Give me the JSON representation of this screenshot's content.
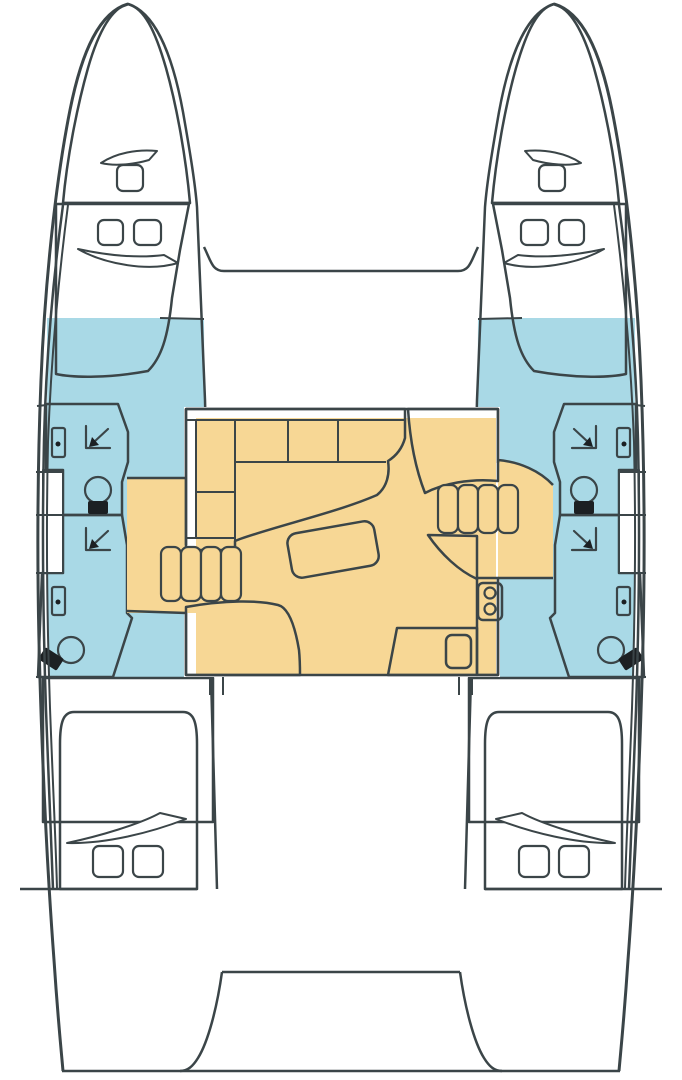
{
  "meta": {
    "diagram_type": "boat-floorplan",
    "subject": "catamaran sailing yacht accommodation layout, top-down view",
    "orientation": "bow at top, stern at bottom",
    "symmetry": "port and starboard hulls mirrored"
  },
  "colors": {
    "outline": "#3b4548",
    "background": "#ffffff",
    "furniture": "#ffffff",
    "foredeck": "#b5cccb",
    "berth": "#92c3cc",
    "cabin": "#a9d9e6",
    "bathroom": "#b7ce92",
    "living": "#f7d795",
    "fixture_black": "#1c2023"
  },
  "layout": {
    "hulls": 2,
    "trampoline_forward": true,
    "cockpit_aft": true,
    "bridgedeck_saloon": {
      "galley_counter_cells": 6,
      "sofa": 1,
      "table": 1,
      "stove_burners": 2,
      "sink": 1,
      "companionway_stairs": 2,
      "steps_per_stair": 4
    },
    "per_hull": {
      "forepeak_berth": 1,
      "bow_hatch": 1,
      "cabin_hatches_forward": 2,
      "bathrooms": 2,
      "toilets": 2,
      "sinks": 2,
      "showers": 2,
      "aft_double_berth": 1,
      "cabin_hatches_aft": 2
    }
  }
}
